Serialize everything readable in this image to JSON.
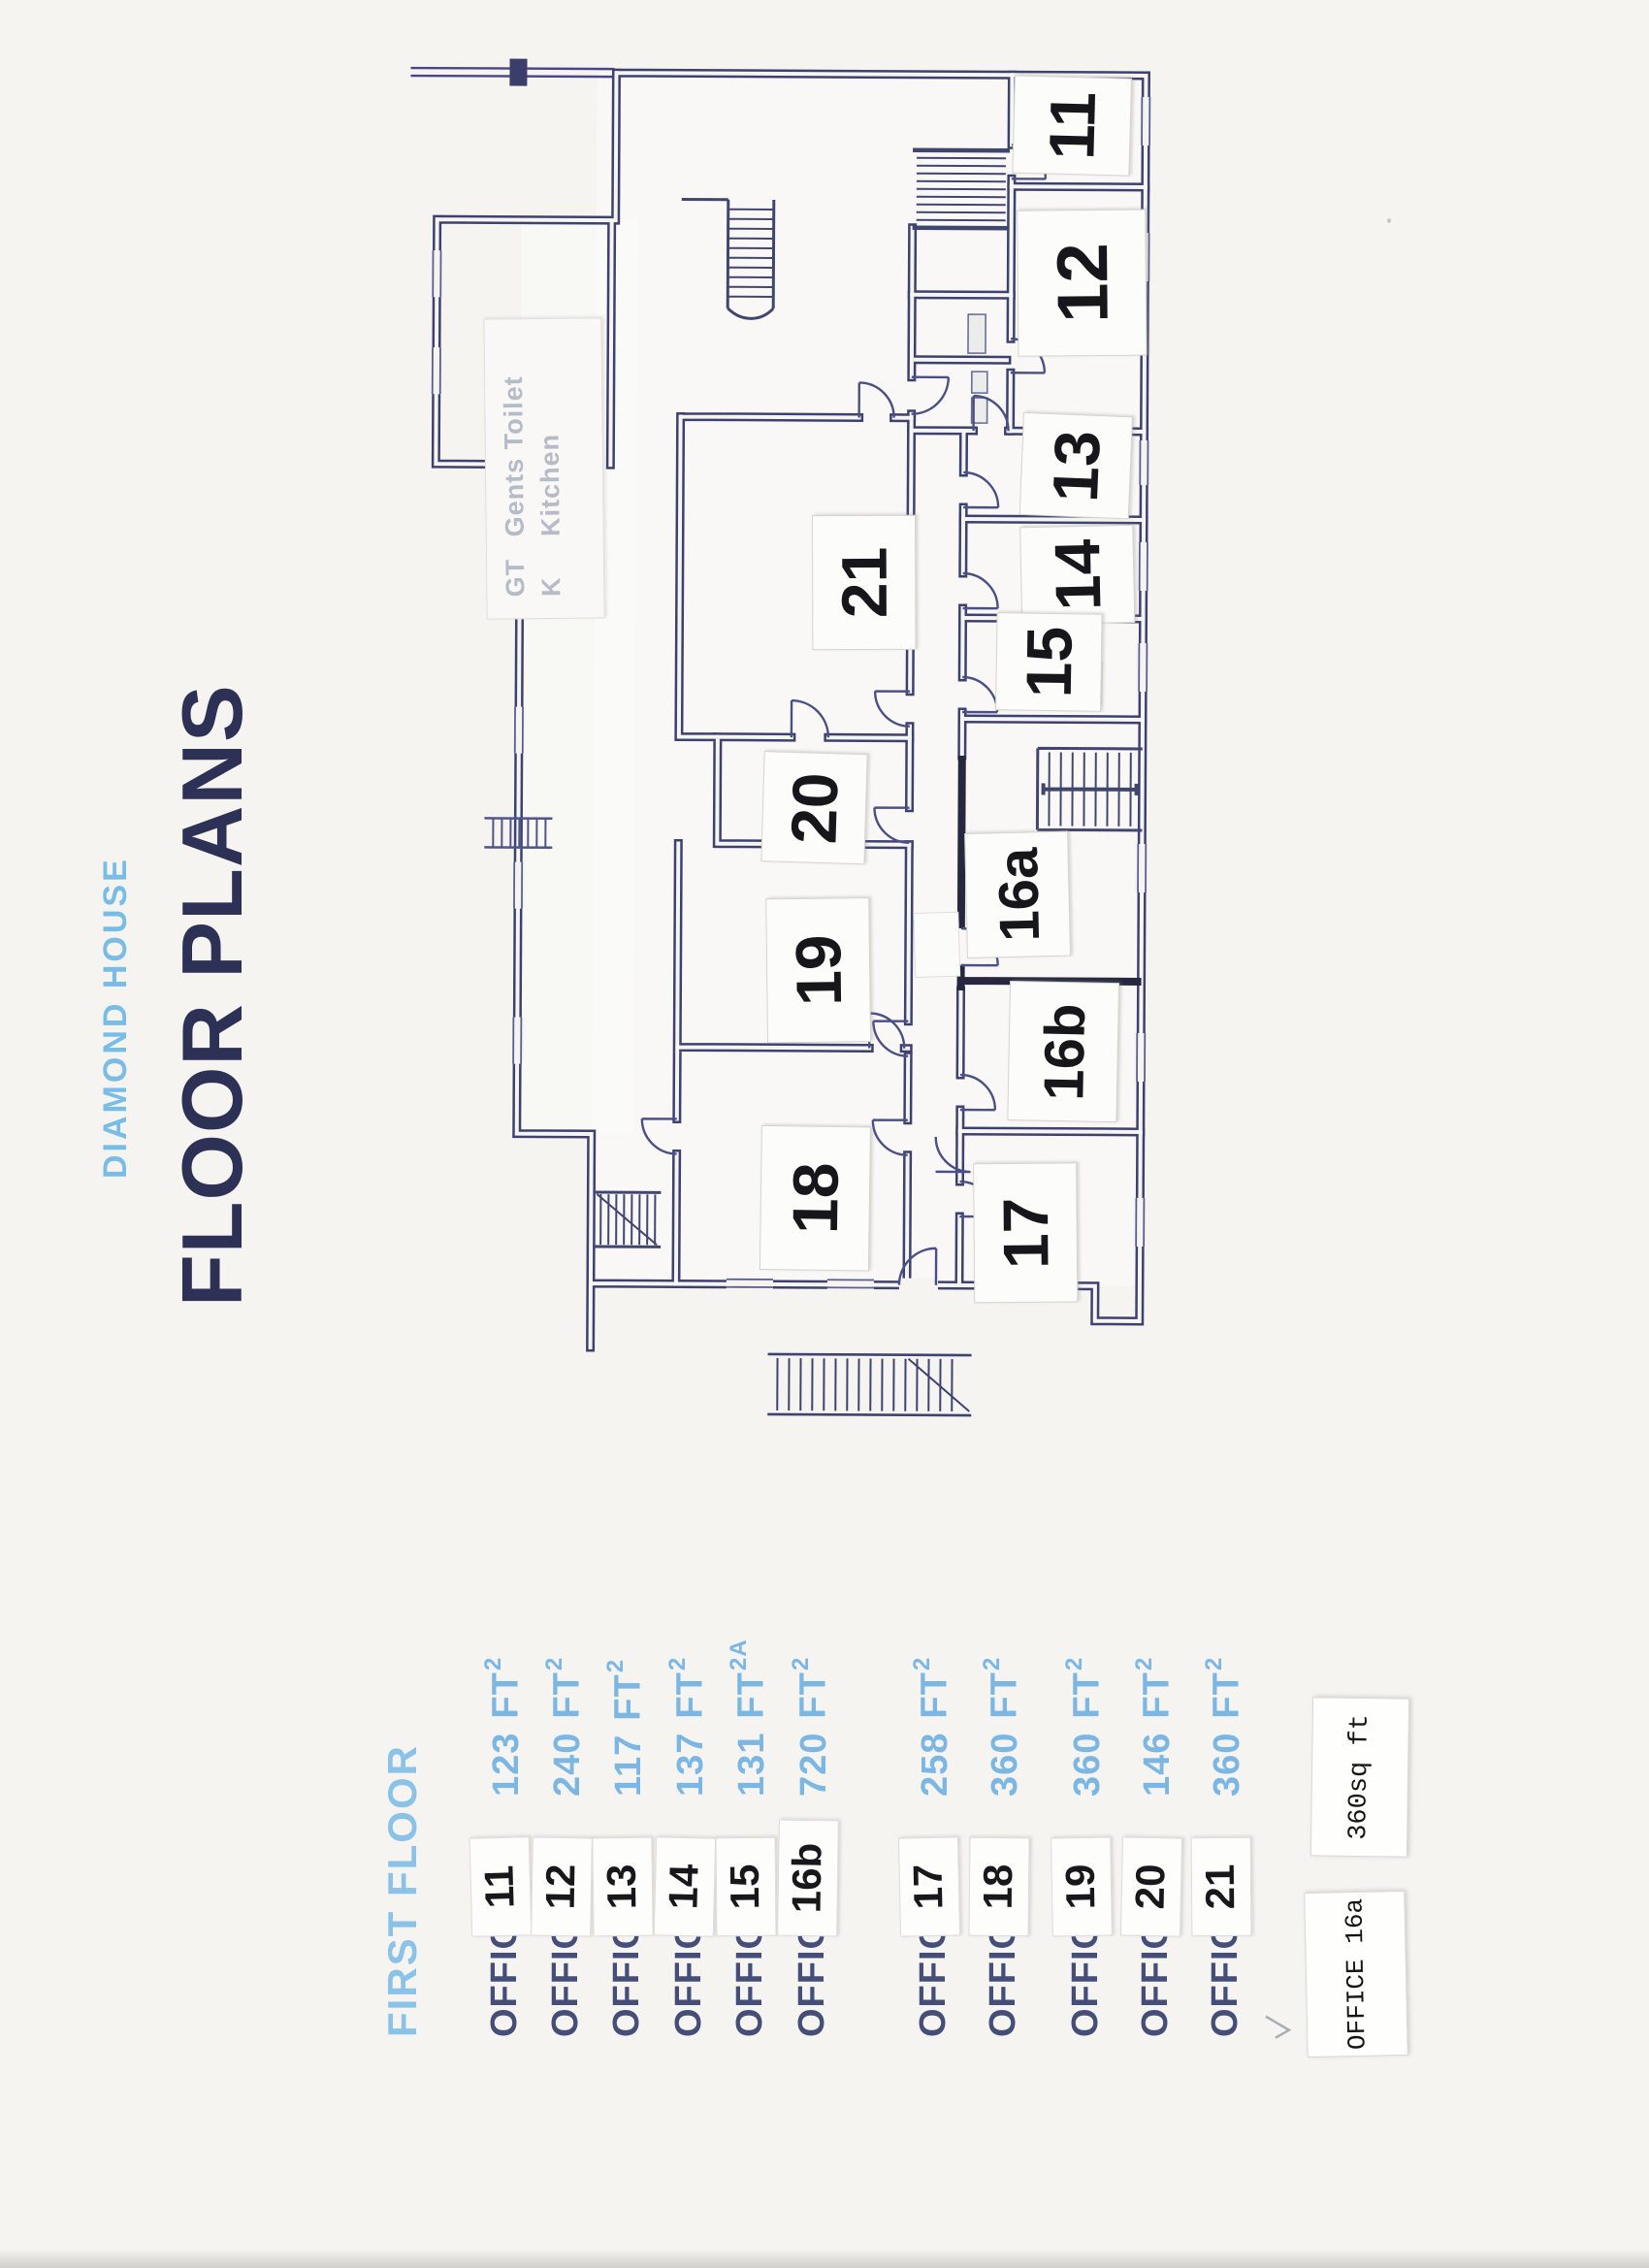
{
  "header": {
    "brand": "DIAMOND HOUSE",
    "title": "FLOOR PLANS"
  },
  "list": {
    "heading": "FIRST FLOOR",
    "items": [
      {
        "label": "OFFICE",
        "number": "11",
        "area_value": "123",
        "area_unit": "FT",
        "area_sup": "2"
      },
      {
        "label": "OFFICE",
        "number": "12",
        "area_value": "240",
        "area_unit": "FT",
        "area_sup": "2"
      },
      {
        "label": "OFFICE",
        "number": "13",
        "area_value": "117",
        "area_unit": "FT",
        "area_sup": "2"
      },
      {
        "label": "OFFICE",
        "number": "14",
        "area_value": "137",
        "area_unit": "FT",
        "area_sup": "2"
      },
      {
        "label": "OFFICE",
        "number": "15",
        "area_value": "131",
        "area_unit": "FT",
        "area_sup": "2A"
      },
      {
        "label": "OFFICE",
        "number": "16b",
        "area_value": "720",
        "area_unit": "FT",
        "area_sup": "2"
      },
      {
        "label": "OFFICE",
        "number": "17",
        "area_value": "258",
        "area_unit": "FT",
        "area_sup": "2"
      },
      {
        "label": "OFFICE",
        "number": "18",
        "area_value": "360",
        "area_unit": "FT",
        "area_sup": "2"
      },
      {
        "label": "OFFICE",
        "number": "19",
        "area_value": "360",
        "area_unit": "FT",
        "area_sup": "2"
      },
      {
        "label": "OFFICE",
        "number": "20",
        "area_value": "146",
        "area_unit": "FT",
        "area_sup": "2"
      },
      {
        "label": "OFFICE",
        "number": "21",
        "area_value": "360",
        "area_unit": "FT",
        "area_sup": "2"
      }
    ]
  },
  "notes": {
    "office_label": "OFFICE 16a",
    "area_label": "360sq ft"
  },
  "legend": {
    "items": [
      {
        "abbr": "GT",
        "label": "Gents Toilet"
      },
      {
        "abbr": "K",
        "label": "Kitchen"
      }
    ]
  },
  "plan": {
    "rooms": [
      {
        "text": "11"
      },
      {
        "text": "12"
      },
      {
        "text": "13"
      },
      {
        "text": "14"
      },
      {
        "text": "15"
      },
      {
        "text": "16a"
      },
      {
        "text": "16b"
      },
      {
        "text": "17"
      },
      {
        "text": "18"
      },
      {
        "text": "19"
      },
      {
        "text": "20"
      },
      {
        "text": "21"
      }
    ]
  },
  "colors": {
    "paper": "#f5f4f1",
    "brand_blue": "#79bde6",
    "title_navy": "#2e3156",
    "heading_blue": "#8ac2e8",
    "office_navy": "#454e79",
    "area_blue": "#7cb6e2",
    "wall_ink": "#3d4170",
    "wall_dark": "#272840",
    "number_ink": "#17171c",
    "legend_grey": "#b5bbc7"
  }
}
